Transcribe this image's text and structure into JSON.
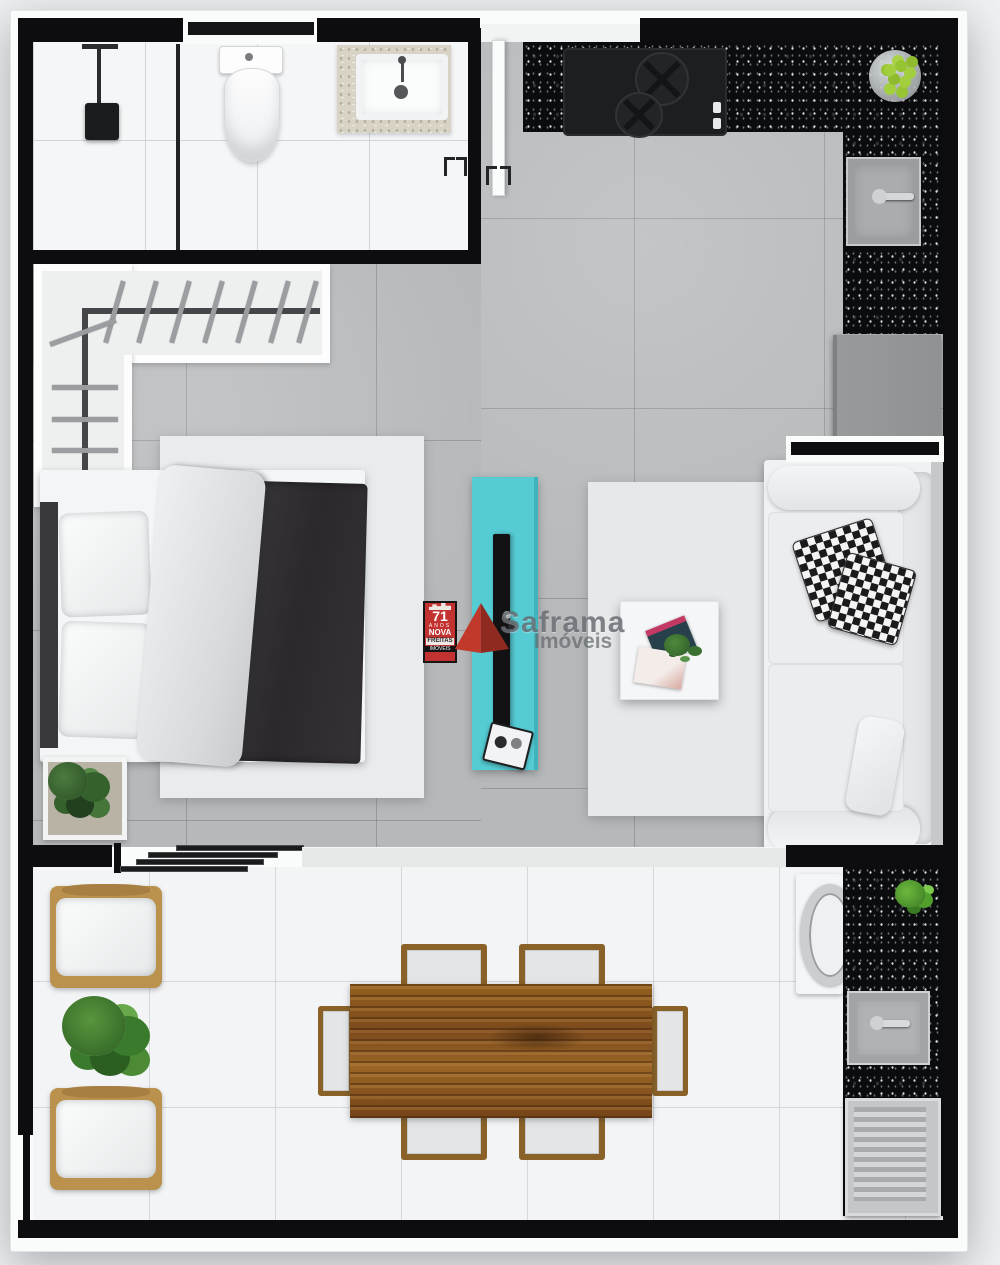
{
  "watermark": {
    "badge": {
      "years": "71",
      "line_anos": "ANOS",
      "line_nova": "NOVA",
      "line_freitas": "FREITAS",
      "line_imoveis": "IMÓVEIS"
    },
    "brand": {
      "name": "Saframa",
      "sub": "Imóveis"
    }
  },
  "scene": {
    "type": "apartment-studio-floor-plan-top-view",
    "rooms": [
      {
        "name": "bathroom",
        "items": [
          "shower-head",
          "glass-partition",
          "toilet",
          "vanity-sink",
          "window"
        ]
      },
      {
        "name": "kitchen",
        "items": [
          "l-shaped-granite-counter",
          "cooktop",
          "fruit-bowl",
          "kitchen-sink",
          "refrigerator",
          "entry-door"
        ]
      },
      {
        "name": "bedroom",
        "items": [
          "l-shaped-closet",
          "hangers",
          "double-bed",
          "pillows",
          "dark-duvet",
          "rug",
          "plant-pot",
          "sliding-door"
        ]
      },
      {
        "name": "living-room",
        "items": [
          "tv-rack",
          "tv",
          "rug",
          "coffee-table",
          "magazines",
          "sofa",
          "patterned-pillows"
        ]
      },
      {
        "name": "balcony",
        "items": [
          "armchair",
          "armchair",
          "plant",
          "dining-table",
          "dining-chairs",
          "washing-machine",
          "granite-counter",
          "laundry-sink",
          "drying-rack",
          "plant-small"
        ]
      }
    ]
  },
  "palette": {
    "wall_black": "#0d0d0f",
    "floor_gray": "#b6b8ba",
    "floor_white": "#f4f5f6",
    "granite_black": "#0b0c0e",
    "tv_rack_cyan": "#55ccd4",
    "wood_brown": "#8a5526",
    "chair_wood": "#8a6228",
    "accent_red": "#c0392b",
    "lime_green": "#a3cf3f",
    "duvet_dark": "#2e2c2d"
  }
}
